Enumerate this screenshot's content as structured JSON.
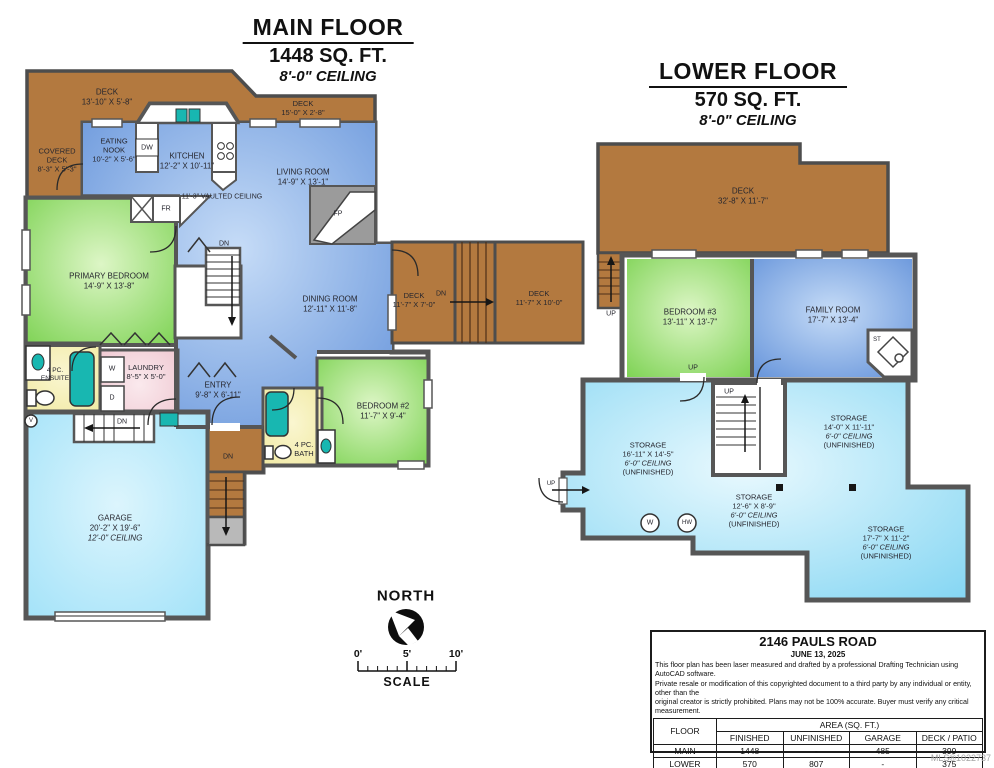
{
  "colors": {
    "deck": "#b3793f",
    "wall": "#565656",
    "room_blue": "#5e8ed8",
    "room_green": "#77d04c",
    "storage_cyan": "#7fd4f2",
    "garage_cyan": "#9fe1f8",
    "bath_yellow": "#f0e9a0",
    "laundry_pink": "#eec3cd",
    "fixture_teal": "#18b7b1",
    "concrete_gray": "#b9b9b9"
  },
  "main_floor": {
    "title": "MAIN FLOOR",
    "area": "1448 SQ. FT.",
    "ceiling": "8'-0\" CEILING",
    "rooms": {
      "deck_top": {
        "name": "DECK",
        "dims": "13'-10\" X 5'-8\""
      },
      "covered_deck": {
        "name1": "COVERED",
        "name2": "DECK",
        "dims": "8'-3\" X 5'-3\""
      },
      "deck_upper_right": {
        "name": "DECK",
        "dims": "15'-0\" X 2'-8\""
      },
      "eating_nook": {
        "name1": "EATING",
        "name2": "NOOK",
        "dims": "10'-2\" X 5'-6\""
      },
      "kitchen": {
        "name": "KITCHEN",
        "dims": "12'-2\" X 10'-11\""
      },
      "living_room": {
        "name": "LIVING ROOM",
        "dims": "14'-9\" X 13'-1\""
      },
      "vaulted_note": "11'-3\" VAULTED CEILING",
      "primary_bedroom": {
        "name": "PRIMARY BEDROOM",
        "dims": "14'-9\" X 13'-8\""
      },
      "dining_room": {
        "name": "DINING ROOM",
        "dims": "12'-11\" X 11'-8\""
      },
      "deck_right_small": {
        "name": "DECK",
        "dims": "11'-7\" X 7'-0\""
      },
      "deck_right_large": {
        "name": "DECK",
        "dims": "11'-7\" X 10'-0\""
      },
      "ensuite": {
        "name1": "4 PC.",
        "name2": "ENSUITE"
      },
      "laundry": {
        "name": "LAUNDRY",
        "dims": "8'-5\" X 5'-0\""
      },
      "entry": {
        "name": "ENTRY",
        "dims": "9'-8\" X 6'-11\""
      },
      "bedroom2": {
        "name": "BEDROOM #2",
        "dims": "11'-7\" X 9'-4\""
      },
      "bath": {
        "name1": "4 PC.",
        "name2": "BATH"
      },
      "garage": {
        "name": "GARAGE",
        "dims": "20'-2\" X 19'-6\"",
        "ceiling": "12'-0\" CEILING"
      }
    }
  },
  "lower_floor": {
    "title": "LOWER FLOOR",
    "area": "570 SQ. FT.",
    "ceiling": "8'-0\" CEILING",
    "rooms": {
      "deck": {
        "name": "DECK",
        "dims": "32'-8\" X 11'-7\""
      },
      "bedroom3": {
        "name": "BEDROOM #3",
        "dims": "13'-11\" X 13'-7\""
      },
      "family_room": {
        "name": "FAMILY ROOM",
        "dims": "17'-7\" X 13'-4\""
      },
      "storage_left": {
        "name": "STORAGE",
        "dims": "16'-11\" X 14'-5\"",
        "ceiling": "6'-0\" CEILING",
        "status": "(UNFINISHED)"
      },
      "storage_mid_right": {
        "name": "STORAGE",
        "dims": "14'-0\" X 11'-11\"",
        "ceiling": "6'-0\" CEILING",
        "status": "(UNFINISHED)"
      },
      "storage_center": {
        "name": "STORAGE",
        "dims": "12'-6\" X 8'-9\"",
        "ceiling": "6'-0\" CEILING",
        "status": "(UNFINISHED)"
      },
      "storage_bottom_right": {
        "name": "STORAGE",
        "dims": "17'-7\" X 11'-2\"",
        "ceiling": "6'-0\" CEILING",
        "status": "(UNFINISHED)"
      }
    }
  },
  "markers": {
    "dn": "DN",
    "up": "UP",
    "dw": "DW",
    "fr": "FR",
    "fp": "FP",
    "st": "ST",
    "w": "W",
    "d": "D",
    "v": "V",
    "hw": "HW"
  },
  "compass": {
    "label": "NORTH"
  },
  "scale_bar": {
    "label": "SCALE",
    "ticks": [
      "0'",
      "5'",
      "10'"
    ]
  },
  "info_box": {
    "address": "2146 PAULS ROAD",
    "date": "JUNE 13, 2025",
    "disclaimer_lines": [
      "This floor plan has been laser measured and drafted by a professional Drafting Technician using AutoCAD software.",
      "Private resale or modification of this copyrighted document to a third party by any individual or entity, other than the",
      "original creator is strictly prohibited. Plans may not be 100% accurate.  Buyer must verify any critical measurement."
    ],
    "table": {
      "floor_header": "FLOOR",
      "area_header": "AREA (SQ. FT.)",
      "columns": [
        "FINISHED",
        "UNFINISHED",
        "GARAGE",
        "DECK / PATIO"
      ],
      "rows": [
        {
          "floor": "MAIN",
          "finished": "1448",
          "unfinished": "-",
          "garage": "485",
          "deck": "399"
        },
        {
          "floor": "LOWER",
          "finished": "570",
          "unfinished": "807",
          "garage": "-",
          "deck": "375"
        },
        {
          "floor": "TOTAL",
          "finished": "2018",
          "unfinished": "807",
          "garage": "485",
          "deck": "774"
        }
      ]
    },
    "mls": "MLS®1022737"
  }
}
